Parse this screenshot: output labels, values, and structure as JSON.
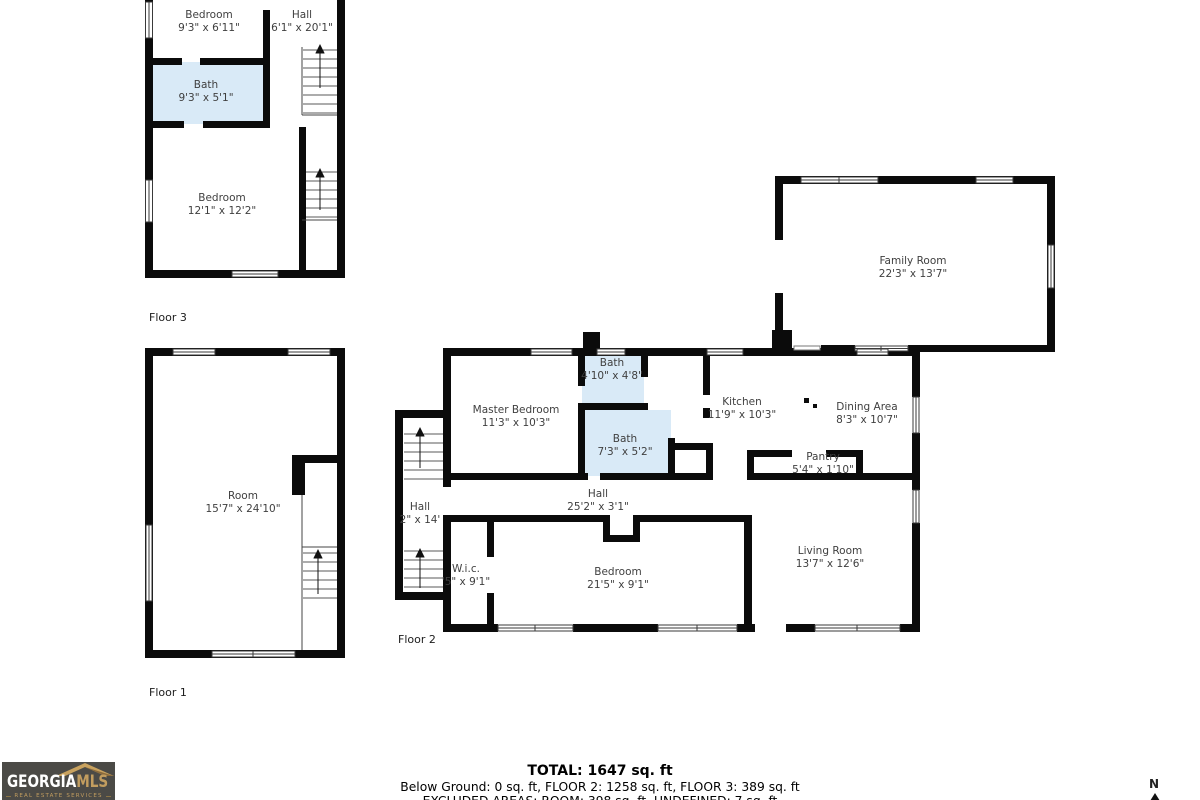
{
  "floors": {
    "floor3": {
      "label": "Floor 3",
      "rooms": {
        "bedroom_top": {
          "name": "Bedroom",
          "dims": "9'3\" x 6'11\""
        },
        "hall": {
          "name": "Hall",
          "dims": "6'1\" x 20'1\""
        },
        "bath": {
          "name": "Bath",
          "dims": "9'3\" x 5'1\""
        },
        "bedroom_main": {
          "name": "Bedroom",
          "dims": "12'1\" x 12'2\""
        }
      }
    },
    "floor1": {
      "label": "Floor 1",
      "rooms": {
        "room": {
          "name": "Room",
          "dims": "15'7\" x 24'10\""
        }
      }
    },
    "floor2": {
      "label": "Floor 2",
      "rooms": {
        "family_room": {
          "name": "Family Room",
          "dims": "22'3\" x 13'7\""
        },
        "bath_top": {
          "name": "Bath",
          "dims": "4'10\" x 4'8\""
        },
        "master_bedroom": {
          "name": "Master Bedroom",
          "dims": "11'3\" x 10'3\""
        },
        "kitchen": {
          "name": "Kitchen",
          "dims": "11'9\" x 10'3\""
        },
        "dining_area": {
          "name": "Dining Area",
          "dims": "8'3\" x 10'7\""
        },
        "bath_mid": {
          "name": "Bath",
          "dims": "7'3\" x 5'2\""
        },
        "pantry": {
          "name": "Pantry",
          "dims": "5'4\" x 1'10\""
        },
        "hall_main": {
          "name": "Hall",
          "dims": "25'2\" x 3'1\""
        },
        "hall_stairs": {
          "name": "Hall",
          "dims": "2\" x 14'"
        },
        "wic": {
          "name": "W.i.c.",
          "dims": "'5\" x 9'1\""
        },
        "bedroom": {
          "name": "Bedroom",
          "dims": "21'5\" x 9'1\""
        },
        "living_room": {
          "name": "Living Room",
          "dims": "13'7\" x 12'6\""
        }
      }
    }
  },
  "summary": {
    "total": "TOTAL: 1647 sq. ft",
    "floors_line": "Below Ground: 0 sq. ft, FLOOR 2: 1258 sq. ft, FLOOR 3: 389 sq. ft",
    "excluded_line": "EXCLUDED AREAS: ROOM: 398 sq. ft, UNDEFINED: 7 sq. ft"
  },
  "logo": {
    "brand_primary": "GEORGIA",
    "brand_secondary": "MLS",
    "tagline": "REAL ESTATE SERVICES"
  },
  "compass": {
    "north_label": "N"
  },
  "colors": {
    "wall": "#0b0b0b",
    "bath_fill": "#d9eaf7",
    "logo_bg": "#4b4a46",
    "logo_gold": "#c29d5f"
  }
}
